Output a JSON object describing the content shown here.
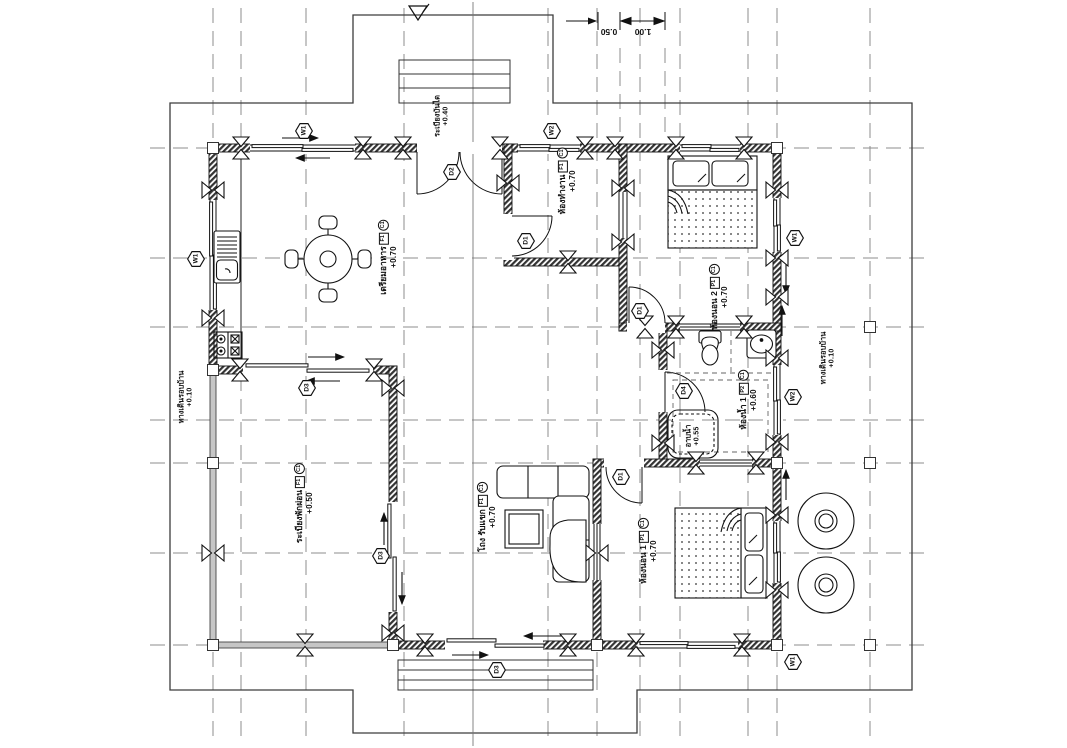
{
  "drawing": {
    "kind": "house floor plan",
    "colors": {
      "line": "#111111",
      "grid": "#8c8c8c",
      "boundary": "#3c3c3c",
      "wall_hatch": "#333333",
      "thin_wall": "#c6c6c6"
    }
  },
  "rooms": [
    {
      "name": "เตรียมอาหาร",
      "floor_tag": "F1",
      "ceiling_tag": "C1",
      "level": "+0.70"
    },
    {
      "name": "ห้องทำงาน",
      "floor_tag": "F1",
      "ceiling_tag": "C1",
      "level": "+0.70"
    },
    {
      "name": "ห้องนอน 2",
      "floor_tag": "P1",
      "ceiling_tag": "C1",
      "level": "+0.70"
    },
    {
      "name": "ห้องน้ำ 1",
      "floor_tag": "P2",
      "ceiling_tag": "C1",
      "level": "+0.60"
    },
    {
      "name": "อาบน้ำ",
      "level": "+0.55"
    },
    {
      "name": "ห้องนอน 1",
      "floor_tag": "P1",
      "ceiling_tag": "C1",
      "level": "+0.70"
    },
    {
      "name": "โถง รับแขก",
      "floor_tag": "F1",
      "ceiling_tag": "C1",
      "level": "+0.70"
    },
    {
      "name": "ระเบียงพักผ่อน",
      "floor_tag": "F1",
      "ceiling_tag": "C1",
      "level": "+0.50"
    },
    {
      "name": "ระเบียงบันได",
      "level": "+0.40"
    },
    {
      "name": "ทางเดินรอบบ้าน",
      "level": "+0.10"
    },
    {
      "name": "ทางเดินรอบบ้าน",
      "level": "+0.10"
    }
  ],
  "door_tags": {
    "d1": "D1",
    "d2": "D2",
    "d3": "D3",
    "d4": "D4"
  },
  "window_tags": {
    "w1": "W1",
    "w2": "W2"
  },
  "dimensions": {
    "small": "0.50",
    "large": "1.00"
  }
}
